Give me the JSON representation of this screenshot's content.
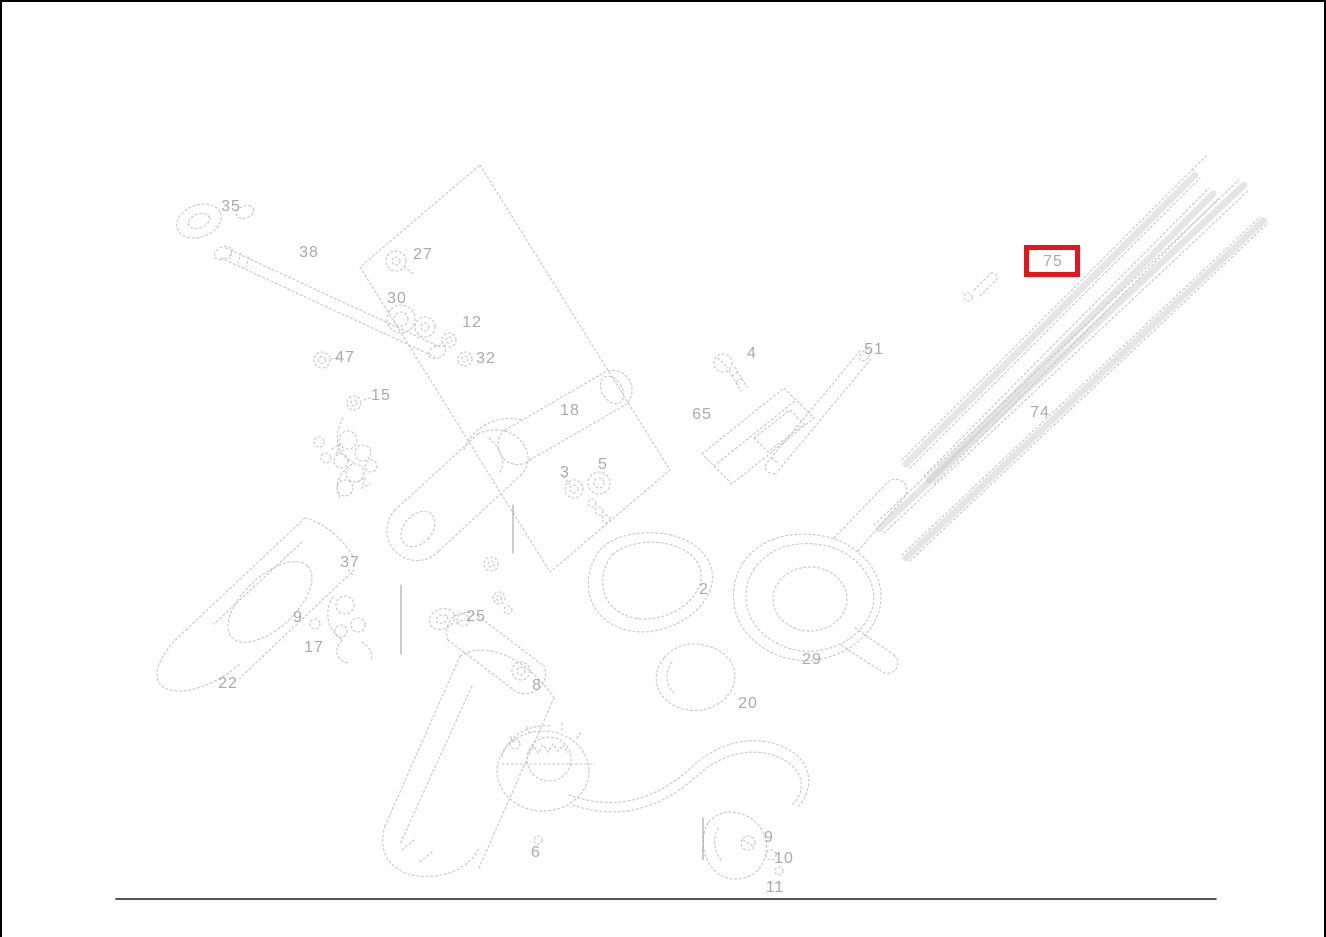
{
  "diagram": {
    "description": "Exploded parts diagram with numbered callouts; part 75 is highlighted",
    "line_color": "#c6c6c6",
    "label_color": "#9f9f9f",
    "frame_color": "#000000",
    "highlight": {
      "part": "75",
      "color": "#e8131c",
      "x": 1022,
      "y": 243,
      "width": 56,
      "height": 32
    },
    "labels": [
      {
        "id": "35",
        "text": "35",
        "x": 229,
        "y": 205
      },
      {
        "id": "38",
        "text": "38",
        "x": 307,
        "y": 251
      },
      {
        "id": "27",
        "text": "27",
        "x": 421,
        "y": 253
      },
      {
        "id": "30",
        "text": "30",
        "x": 395,
        "y": 297
      },
      {
        "id": "12",
        "text": "12",
        "x": 470,
        "y": 321
      },
      {
        "id": "32",
        "text": "32",
        "x": 484,
        "y": 357
      },
      {
        "id": "47",
        "text": "47",
        "x": 343,
        "y": 356
      },
      {
        "id": "15",
        "text": "15",
        "x": 379,
        "y": 394
      },
      {
        "id": "18",
        "text": "18",
        "x": 568,
        "y": 409
      },
      {
        "id": "3",
        "text": "3",
        "x": 563,
        "y": 471
      },
      {
        "id": "5",
        "text": "5",
        "x": 601,
        "y": 463
      },
      {
        "id": "65",
        "text": "65",
        "x": 700,
        "y": 413
      },
      {
        "id": "4",
        "text": "4",
        "x": 750,
        "y": 352
      },
      {
        "id": "51",
        "text": "51",
        "x": 872,
        "y": 348
      },
      {
        "id": "75",
        "text": "75",
        "x": 1051,
        "y": 260,
        "highlighted": true
      },
      {
        "id": "74",
        "text": "74",
        "x": 1038,
        "y": 411
      },
      {
        "id": "2",
        "text": "2",
        "x": 702,
        "y": 588
      },
      {
        "id": "29",
        "text": "29",
        "x": 810,
        "y": 658
      },
      {
        "id": "20",
        "text": "20",
        "x": 746,
        "y": 702
      },
      {
        "id": "37",
        "text": "37",
        "x": 348,
        "y": 561
      },
      {
        "id": "9a",
        "text": "9",
        "x": 296,
        "y": 616
      },
      {
        "id": "17",
        "text": "17",
        "x": 312,
        "y": 646
      },
      {
        "id": "22",
        "text": "22",
        "x": 226,
        "y": 682
      },
      {
        "id": "25",
        "text": "25",
        "x": 474,
        "y": 615
      },
      {
        "id": "8",
        "text": "8",
        "x": 535,
        "y": 684
      },
      {
        "id": "6",
        "text": "6",
        "x": 534,
        "y": 851
      },
      {
        "id": "9b",
        "text": "9",
        "x": 767,
        "y": 836
      },
      {
        "id": "10",
        "text": "10",
        "x": 782,
        "y": 857
      },
      {
        "id": "11",
        "text": "11",
        "x": 773,
        "y": 886
      }
    ]
  }
}
